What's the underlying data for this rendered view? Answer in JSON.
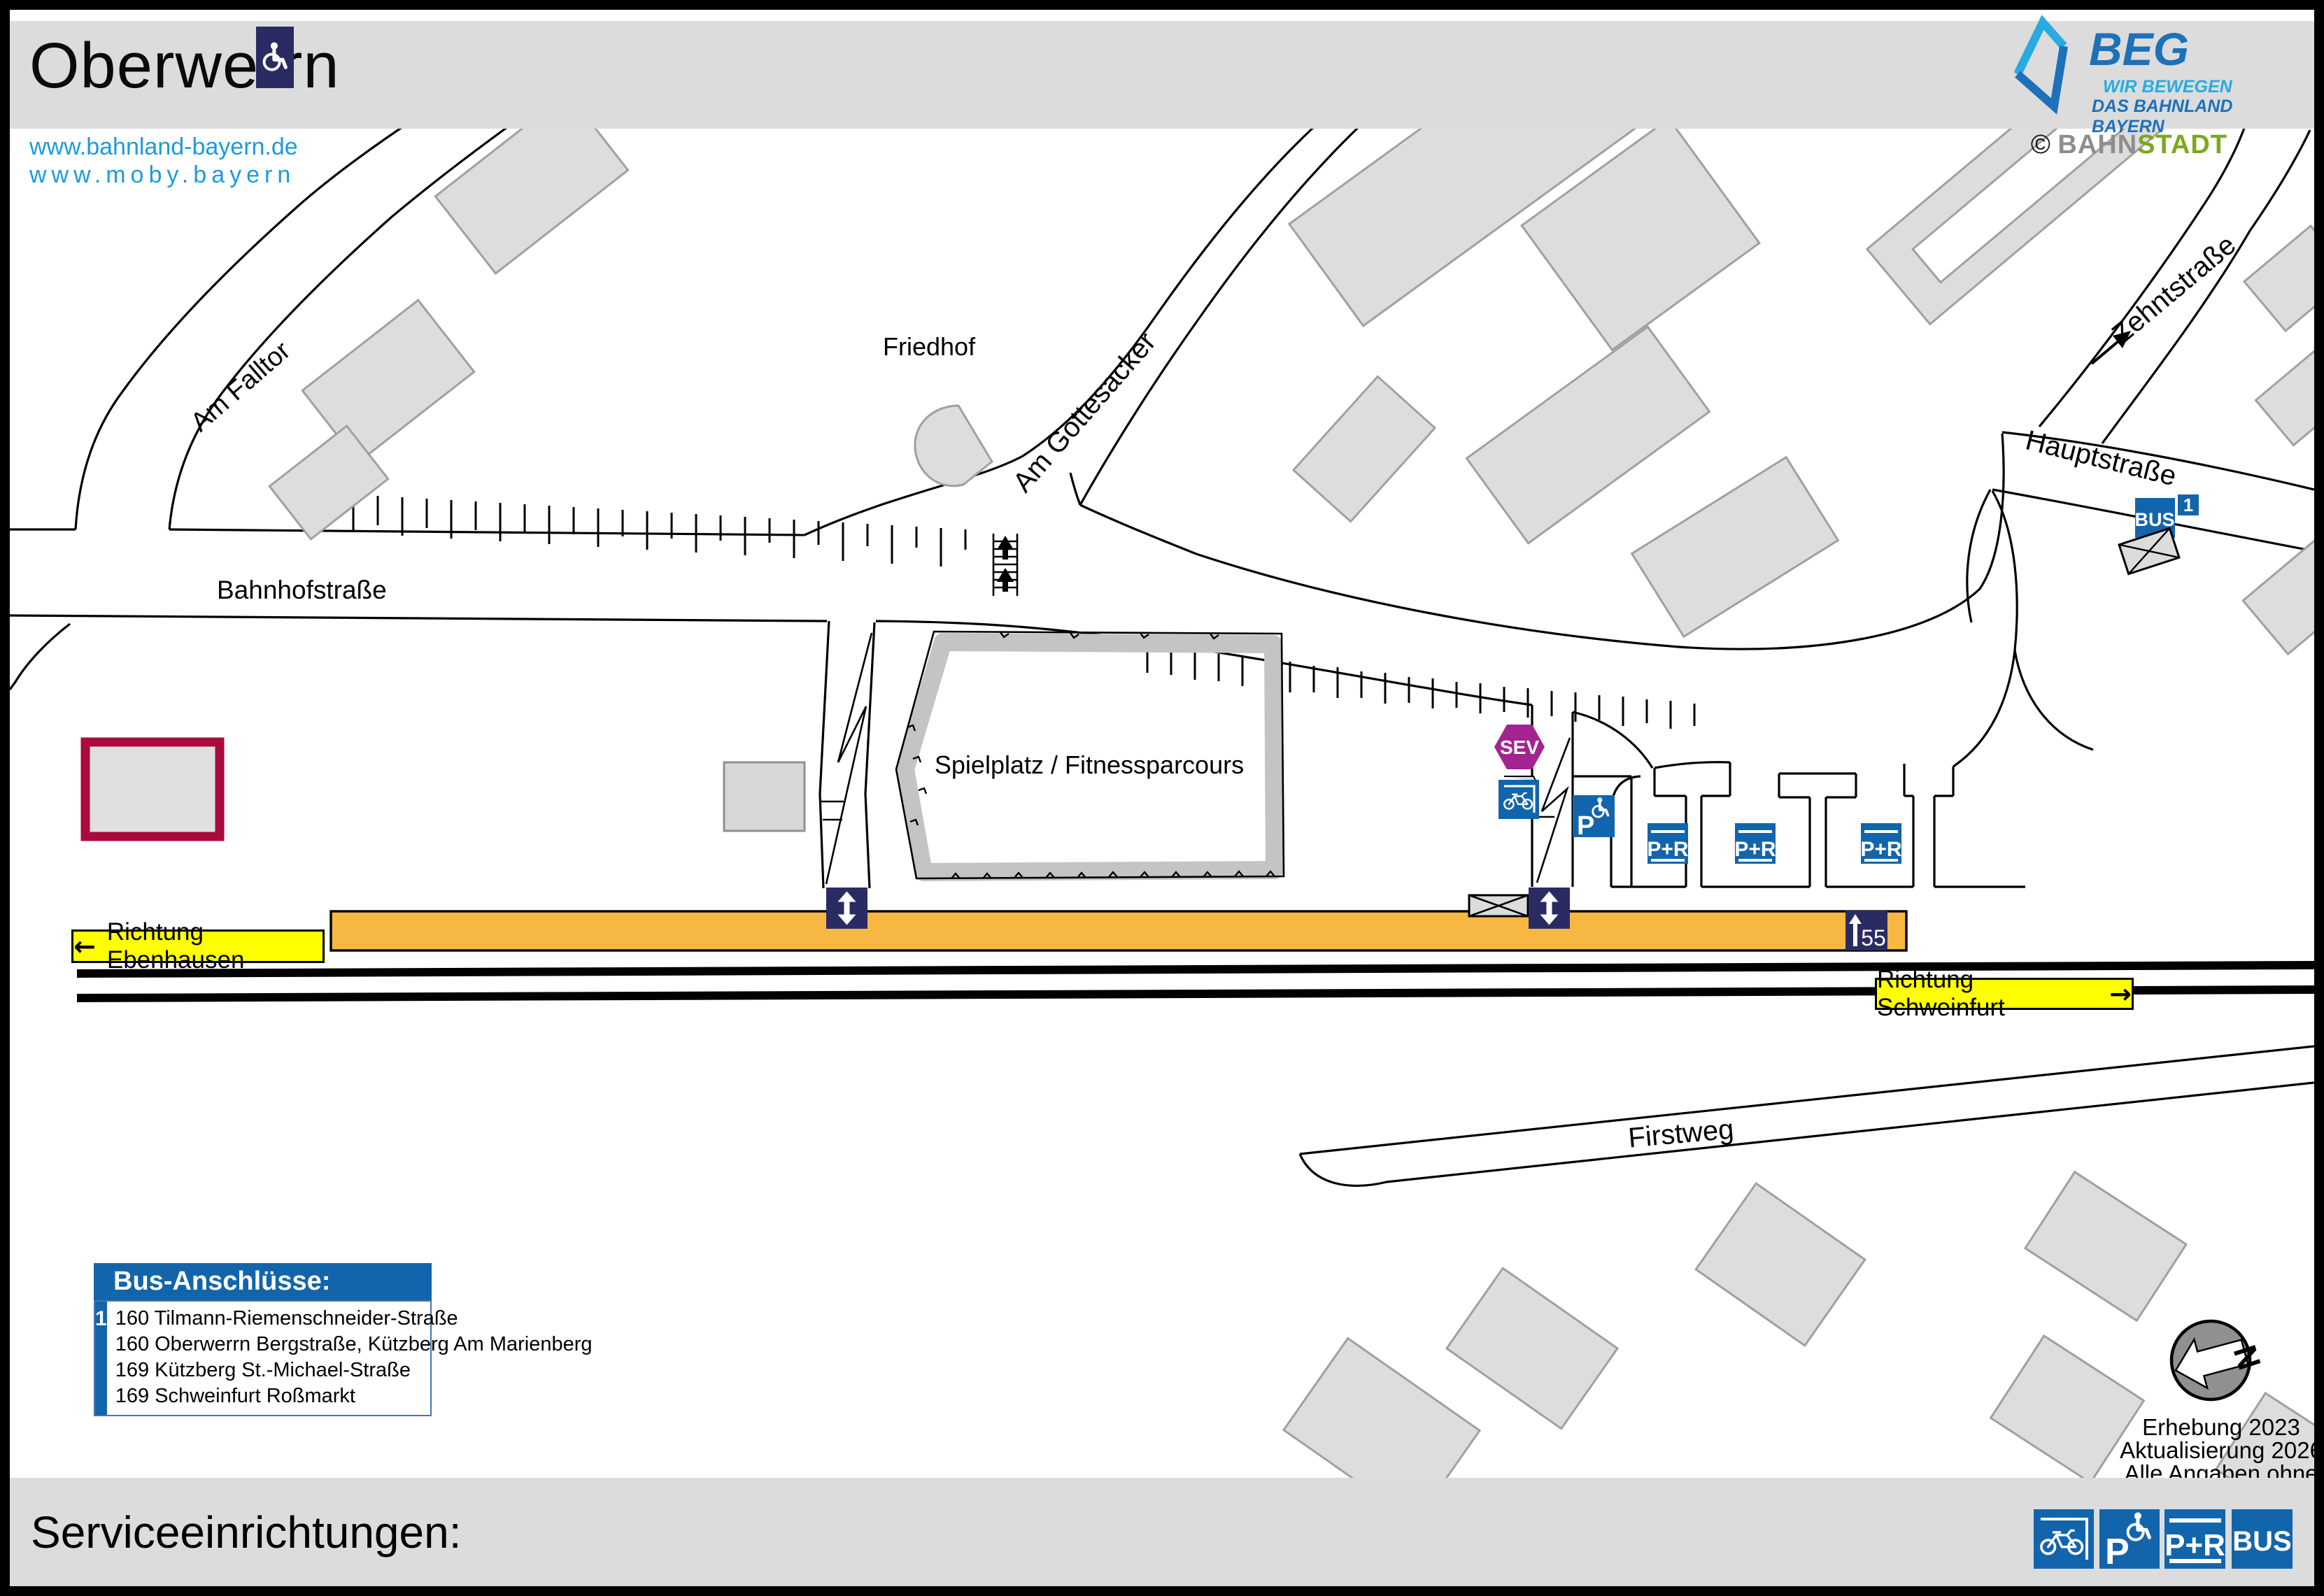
{
  "header": {
    "title": "Oberwerrn",
    "beg": {
      "name": "BEG",
      "tagline1": "WIR BEWEGEN",
      "tagline2": "DAS BAHNLAND BAYERN"
    },
    "credit": {
      "copyright": "©",
      "part1": "BAHN",
      "part2": "STADT"
    }
  },
  "links": {
    "line1": "www.bahnland-bayern.de",
    "line2": "www.moby.bayern"
  },
  "map": {
    "streets": {
      "bahnhofstrasse": "Bahnhofstraße",
      "am_falltor": "Am Falltor",
      "am_gottesacker": "Am Gottesacker",
      "hauptstrasse": "Hauptstraße",
      "zehntstrasse": "Zehntstraße",
      "firstweg": "Firstweg"
    },
    "areas": {
      "friedhof": "Friedhof",
      "spielplatz": "Spielplatz / Fitnessparcours"
    },
    "directions": {
      "left": "Richtung Ebenhausen",
      "right": "Richtung Schweinfurt",
      "arrow_left": "←",
      "arrow_right": "→"
    },
    "icons": {
      "sev": "SEV",
      "bus": "BUS",
      "bus_stop_number": "1",
      "platform_height": "55",
      "parking": "P",
      "park_and_ride": "P+R",
      "compass_n": "N"
    },
    "colors": {
      "icon_blue": "#1265AB",
      "navy": "#2B2B63",
      "sev_purple": "#A32490",
      "platform_orange": "#F7B843",
      "label_yellow": "#FFFF00",
      "building_gray": "#DDDDDD",
      "highlight_red": "#AA0A3C",
      "beg_dark_blue": "#1D71B8",
      "beg_light_blue": "#29ABE2",
      "bahnstadt_green": "#7CA81E"
    }
  },
  "bus_connections": {
    "title": "Bus-Anschlüsse:",
    "stop_number": "1",
    "routes": [
      "160 Tilmann-Riemenschneider-Straße",
      "160 Oberwerrn Bergstraße, Kützberg Am Marienberg",
      "169 Kützberg St.-Michael-Straße",
      "169 Schweinfurt Roßmarkt"
    ]
  },
  "footnote": {
    "line1": "Erhebung 2023",
    "line2": "Aktualisierung 2026",
    "line3": "Alle Angaben ohne Gewähr!"
  },
  "footer": {
    "title": "Serviceeinrichtungen:"
  }
}
